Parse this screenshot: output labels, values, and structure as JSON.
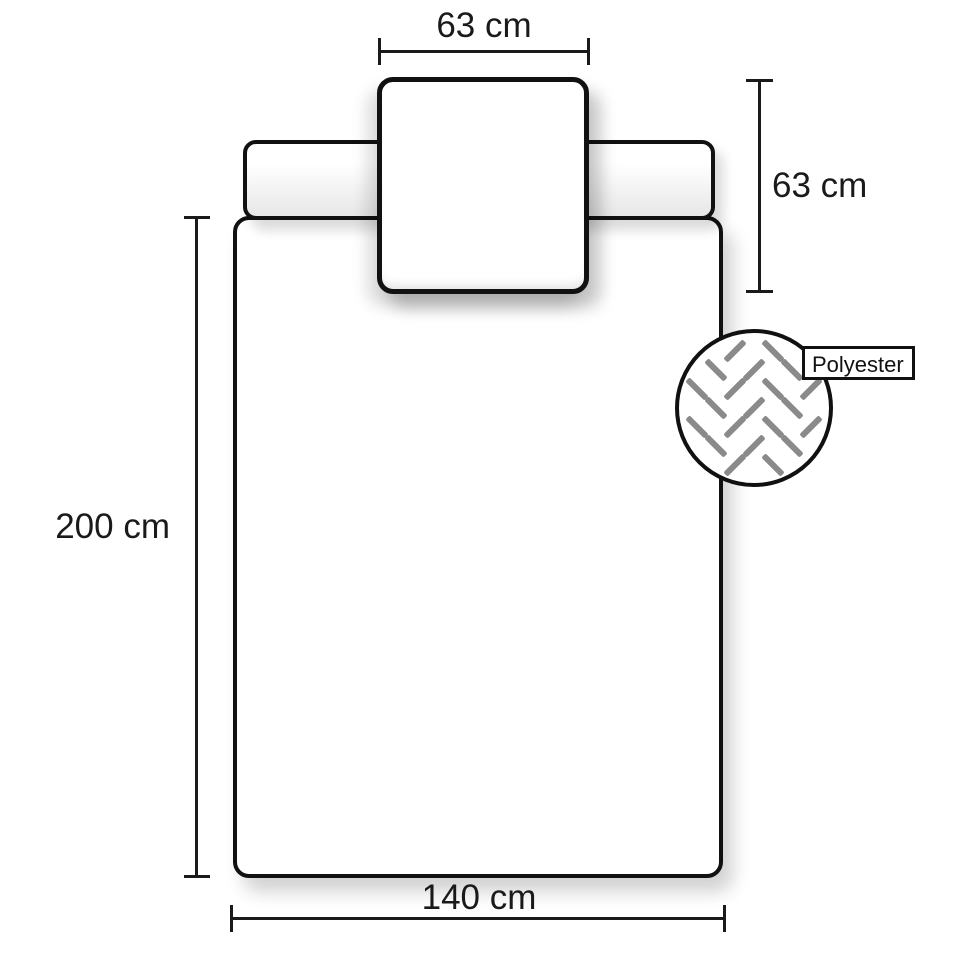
{
  "diagram": {
    "title_hint": "bedding-dimensions",
    "dimensions": {
      "pillow_width_label": "63 cm",
      "pillow_height_label": "63 cm",
      "duvet_length_label": "200 cm",
      "duvet_width_label": "140 cm"
    },
    "material": {
      "label": "Polyester"
    },
    "colors": {
      "outline": "#111111",
      "dimension": "#1a1a1a",
      "weave": "#8a8a8a",
      "background": "#ffffff"
    }
  }
}
